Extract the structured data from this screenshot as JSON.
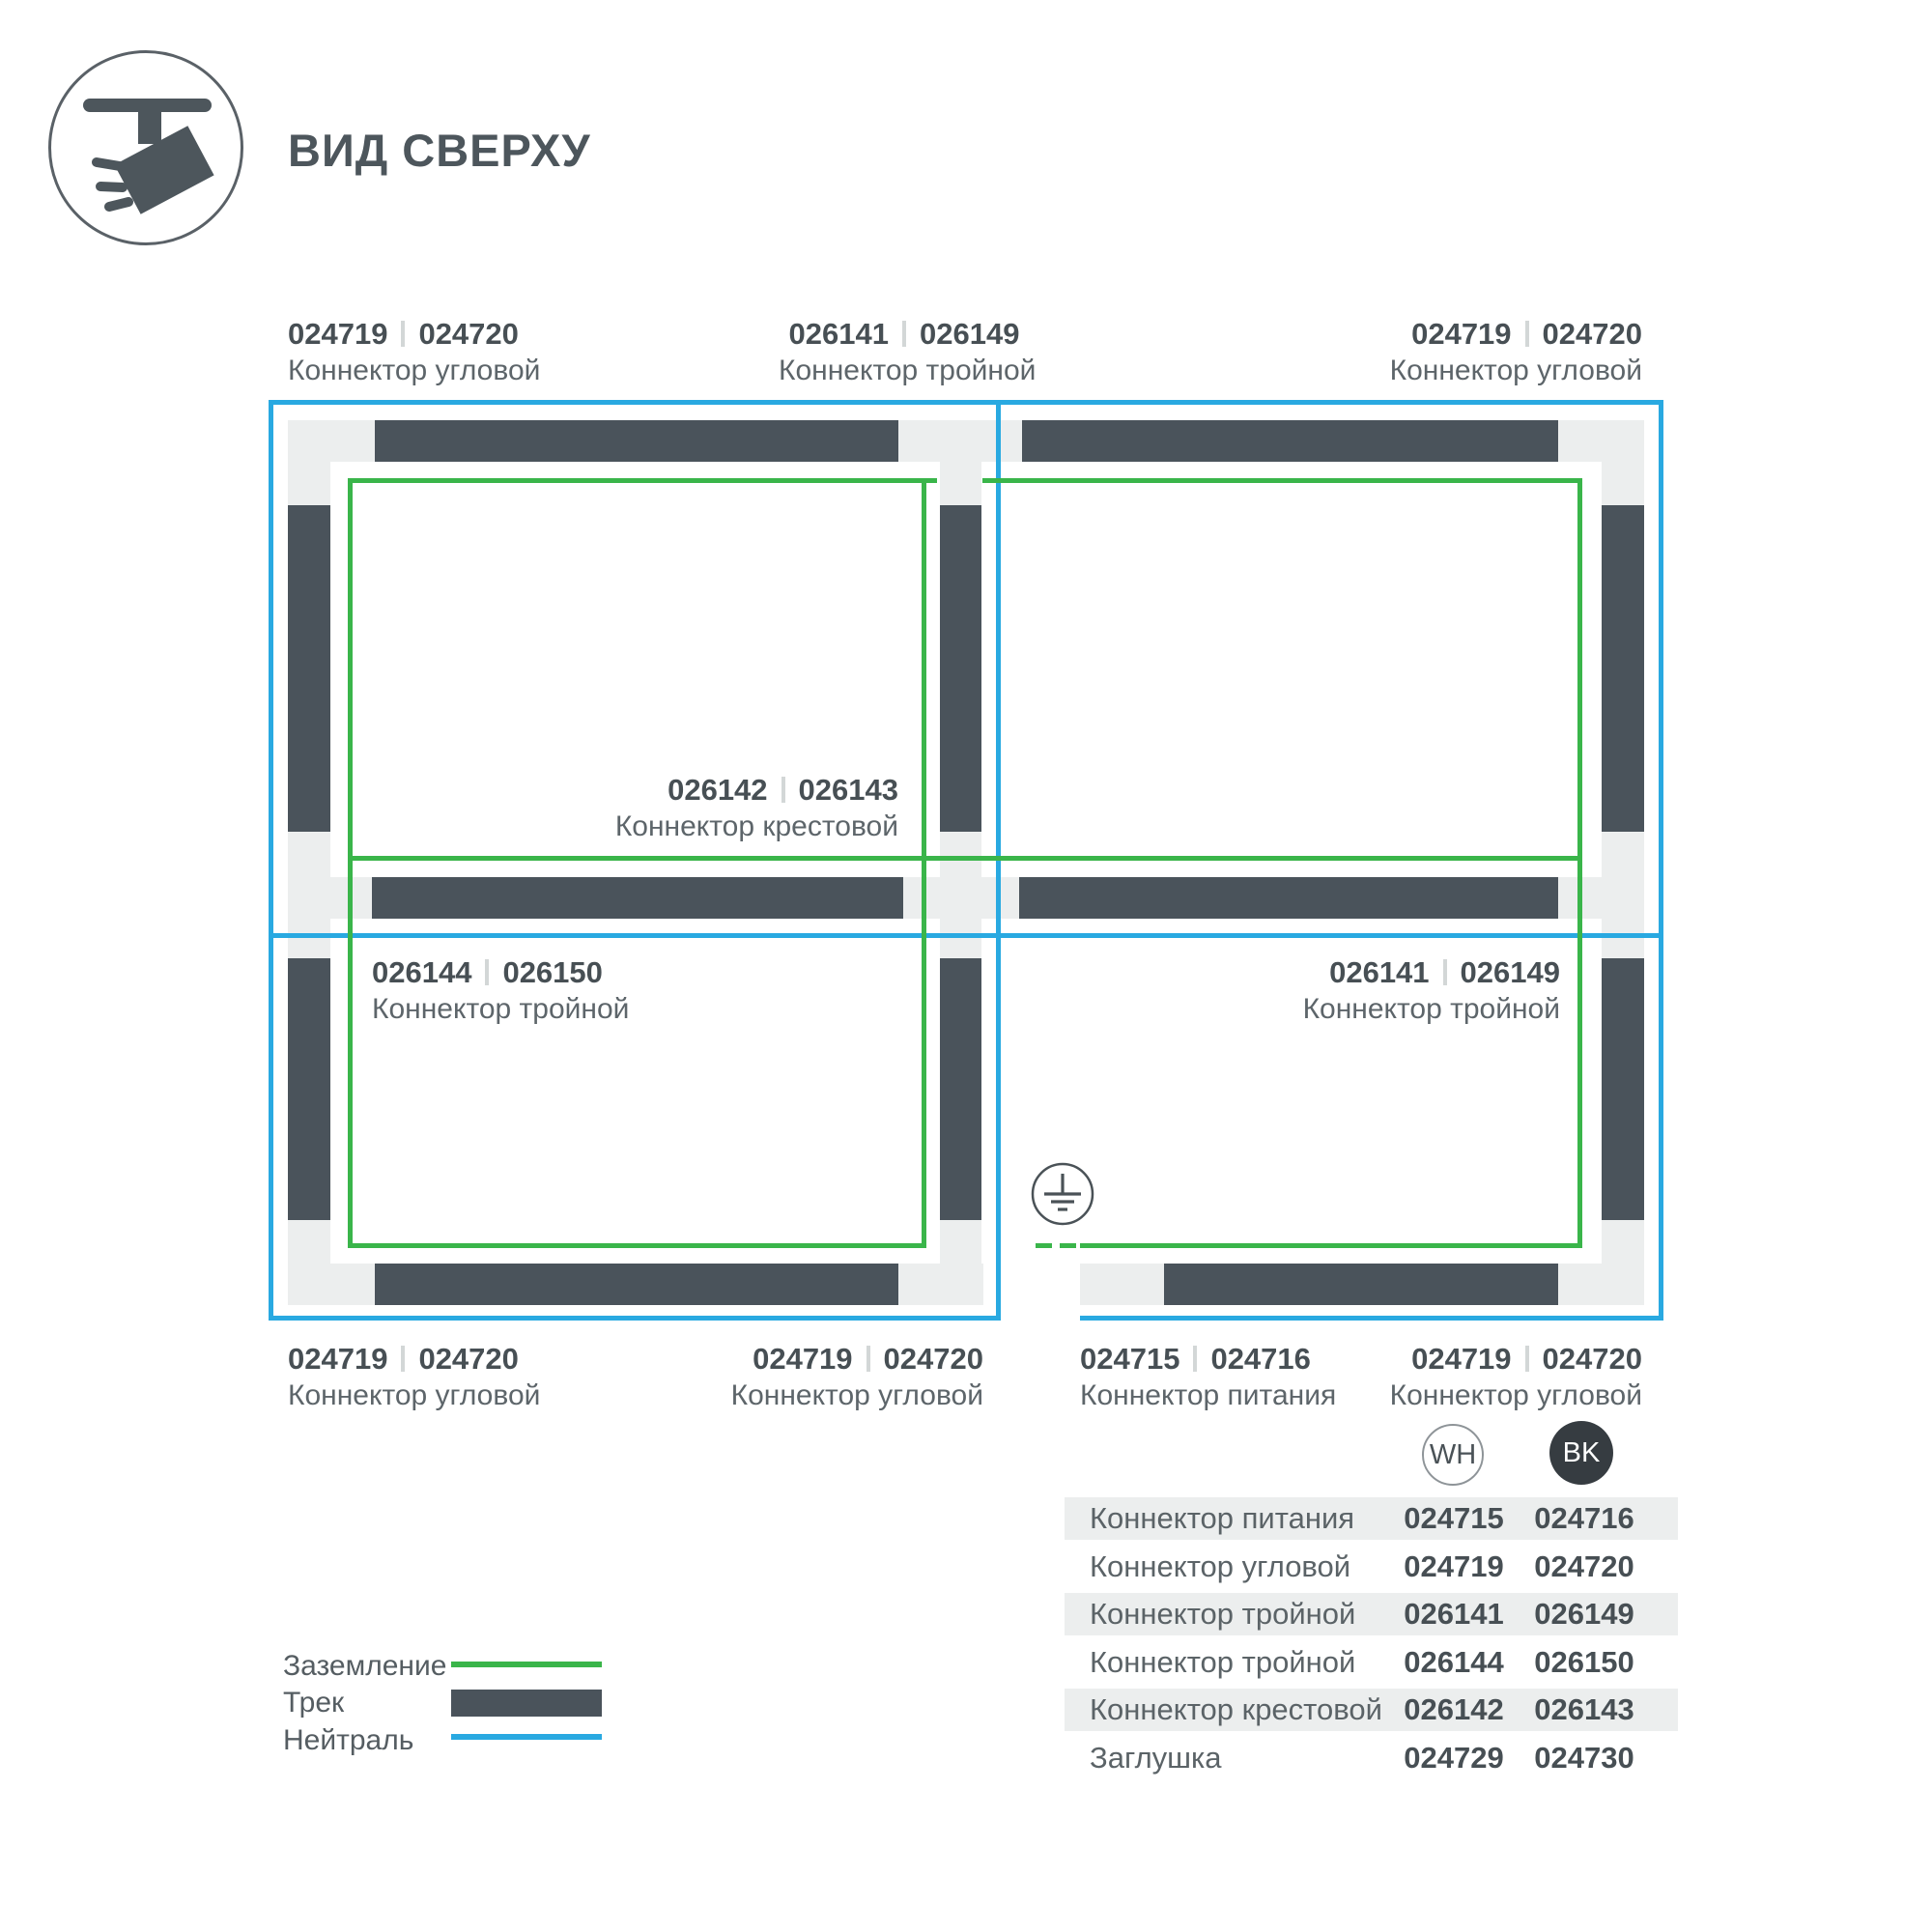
{
  "header": {
    "title": "ВИД СВЕРХУ",
    "icon": "track-spotlight-icon"
  },
  "diagram": {
    "labels": [
      {
        "pos": "top-left",
        "code_wh": "024719",
        "code_bk": "024720",
        "name": "Коннектор угловой"
      },
      {
        "pos": "top-center",
        "code_wh": "026141",
        "code_bk": "026149",
        "name": "Коннектор тройной"
      },
      {
        "pos": "top-right",
        "code_wh": "024719",
        "code_bk": "024720",
        "name": "Коннектор угловой"
      },
      {
        "pos": "center-cross",
        "code_wh": "026142",
        "code_bk": "026143",
        "name": "Коннектор крестовой"
      },
      {
        "pos": "middle-left",
        "code_wh": "026144",
        "code_bk": "026150",
        "name": "Коннектор тройной"
      },
      {
        "pos": "middle-right",
        "code_wh": "026141",
        "code_bk": "026149",
        "name": "Коннектор тройной"
      },
      {
        "pos": "bottom-left",
        "code_wh": "024719",
        "code_bk": "024720",
        "name": "Коннектор угловой"
      },
      {
        "pos": "bottom-center",
        "code_wh": "024719",
        "code_bk": "024720",
        "name": "Коннектор угловой"
      },
      {
        "pos": "bottom-power",
        "code_wh": "024715",
        "code_bk": "024716",
        "name": "Коннектор питания"
      },
      {
        "pos": "bottom-right",
        "code_wh": "024719",
        "code_bk": "024720",
        "name": "Коннектор угловой"
      }
    ],
    "ground_icon": "earth-ground-icon"
  },
  "legend": {
    "items": [
      {
        "label": "Заземление",
        "swatch": "ground-green-line"
      },
      {
        "label": "Трек",
        "swatch": "track-dark-bar"
      },
      {
        "label": "Нейтраль",
        "swatch": "neutral-blue-line"
      }
    ]
  },
  "table": {
    "columns": [
      {
        "id": "wh",
        "label": "WH"
      },
      {
        "id": "bk",
        "label": "BK"
      }
    ],
    "rows": [
      {
        "name": "Коннектор питания",
        "wh": "024715",
        "bk": "024716"
      },
      {
        "name": "Коннектор угловой",
        "wh": "024719",
        "bk": "024720"
      },
      {
        "name": "Коннектор тройной",
        "wh": "026141",
        "bk": "026149"
      },
      {
        "name": "Коннектор тройной",
        "wh": "026144",
        "bk": "026150"
      },
      {
        "name": "Коннектор крестовой",
        "wh": "026142",
        "bk": "026143"
      },
      {
        "name": "Заглушка",
        "wh": "024729",
        "bk": "024730"
      }
    ]
  },
  "colors": {
    "ground_green": "#3ab54a",
    "neutral_blue": "#29a9e1",
    "track_dark": "#4a535b",
    "connector_gray": "#eceeee"
  }
}
